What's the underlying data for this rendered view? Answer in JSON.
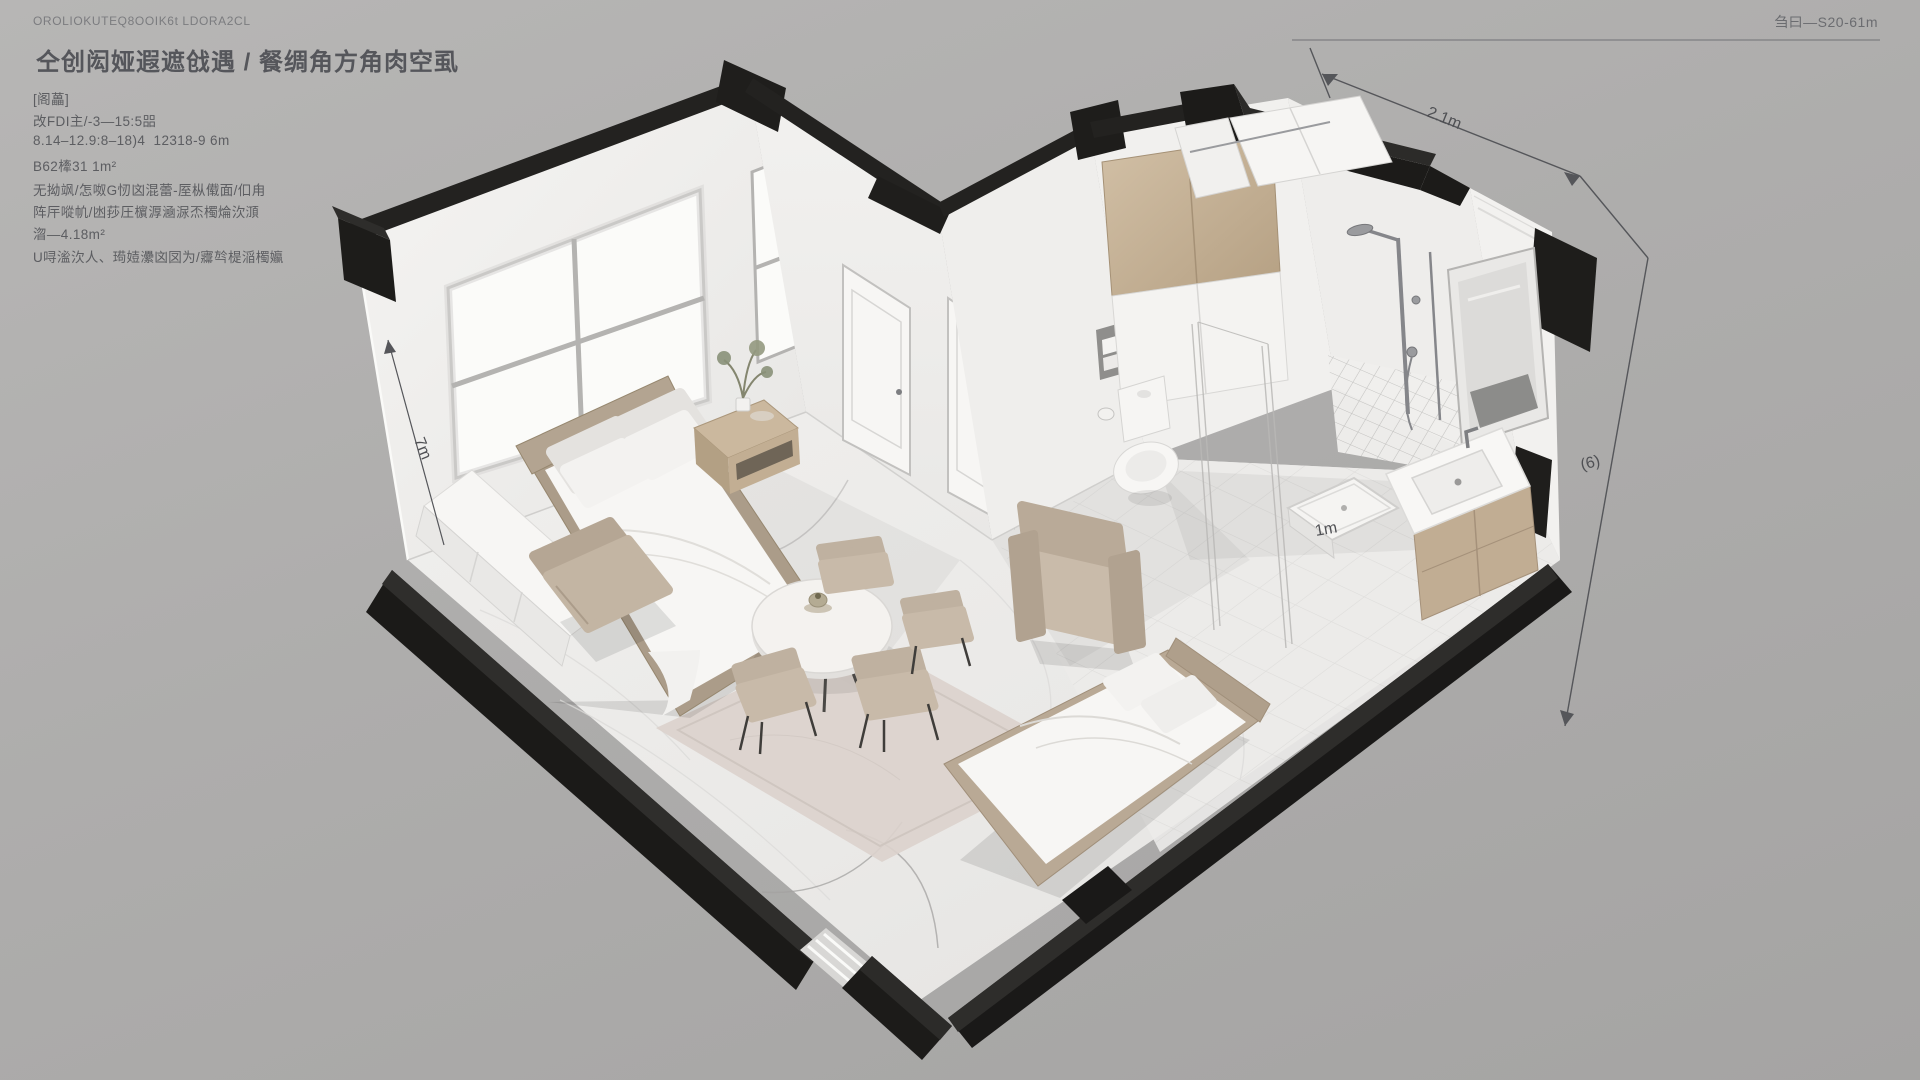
{
  "header": {
    "top_left_code": "OROLIOKUTEQ8OOIK6t LDORA2CL",
    "top_right_code": "刍曰—S20-61m"
  },
  "info_panel": {
    "title": "仝创闳娅遐遮戗遇 / 餐绸角方角肉空虱",
    "lines": [
      "[阁藟]",
      "改FDI主/-3—15:5㗊",
      "8.14–12.9:8–18)4  12318-9 6m",
      "B62㯠31 1m²",
      "无拗飒/怎呶G㣼㓙混蕾-厔枞傤面/㐰甪",
      "阵厈㗰㠶/凼莏圧㯽㴟㴠㳮㶨㯮㷍㳄㴿",
      "㳷—4.18m²",
      "U㖊㴵㳄人、㻤㛸㶟㓙㘝为/㝲㫇㮛㴞㯮㜲"
    ]
  },
  "annotations": {
    "top_dim": "2.1m",
    "right_dim": "(6)",
    "wall_dim": "7m",
    "tray_dim": "1m"
  },
  "colors": {
    "background": "#adacab",
    "wall_black": "#1c1b19",
    "wall_white": "#f2f1ef",
    "floor": "#ecebe9",
    "wood": "#c4b096",
    "upholstery": "#c3b5a3",
    "annotation_text": "#4f5054"
  }
}
